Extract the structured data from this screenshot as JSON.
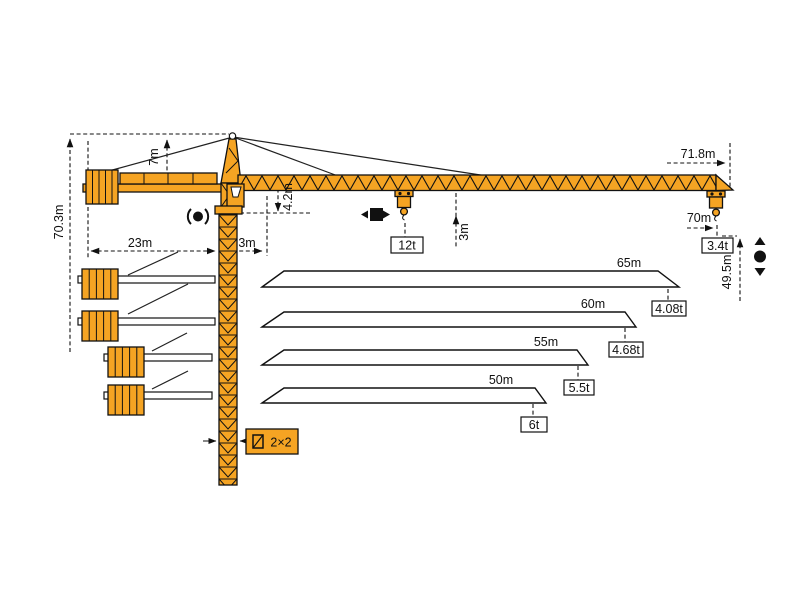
{
  "diagram_title": "tower-crane-dimensions-and-capacities",
  "colors": {
    "crane_yellow": "#F5A423",
    "line_black": "#111111",
    "white": "#ffffff"
  },
  "dims": {
    "height_total": "70.3m",
    "apex_drop": "7m",
    "counterjib_radius": "23m",
    "slew_offset": "3m",
    "heel_drop": "4.2m",
    "under_jib": "3m",
    "tip_radius": "71.8m",
    "hook_radius": "70m",
    "hook_height": "49.5m",
    "mast_section": "2×2"
  },
  "loads": {
    "max": "12t",
    "tip": "3.4t"
  },
  "jib_options": [
    {
      "length": "65m",
      "tip_load": "4.08t"
    },
    {
      "length": "60m",
      "tip_load": "4.68t"
    },
    {
      "length": "55m",
      "tip_load": "5.5t"
    },
    {
      "length": "50m",
      "tip_load": "6t"
    }
  ]
}
